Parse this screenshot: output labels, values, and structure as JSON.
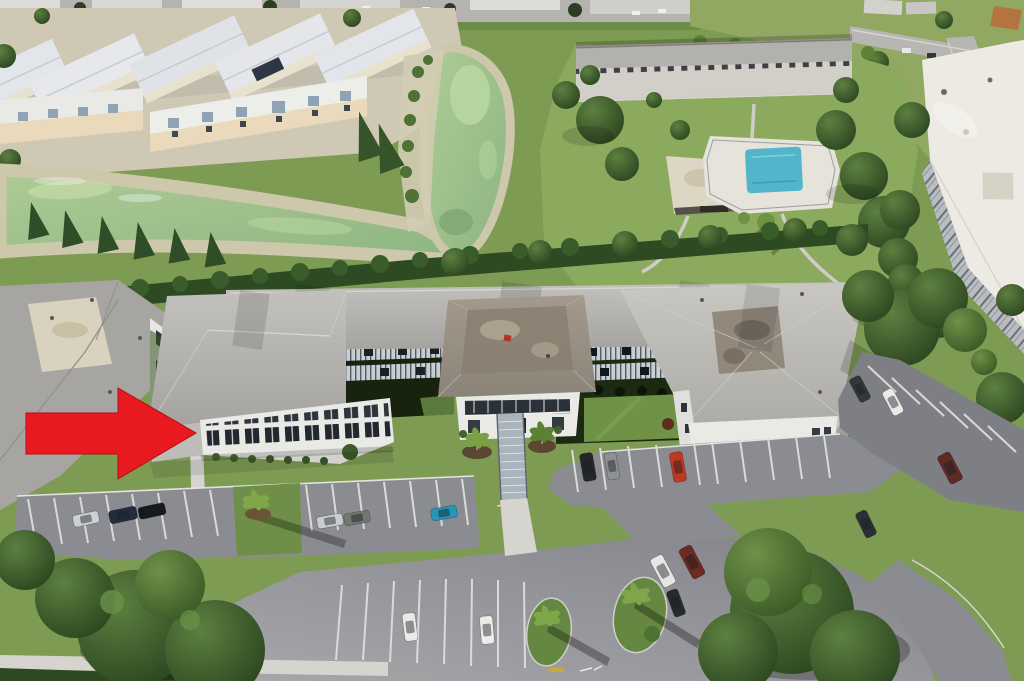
{
  "scene": {
    "type": "aerial-drone-photo",
    "subject": "three-story condominium building with hip roofs, central entrance tower and two courtyards",
    "surroundings": [
      "townhouse-complex",
      "green-pond-and-canal",
      "tree-hedge-row",
      "neighbor-condo-buildings",
      "community-pool-with-clubhouse",
      "high-rise-condo",
      "parking-lots-with-cars",
      "mature-trees-and-palms"
    ]
  },
  "annotation": {
    "arrow_color": "#e8191f",
    "arrow_outline": "#b40e14",
    "direction": "right",
    "points_to": "ground-floor corner unit of the left wing"
  },
  "palette": {
    "water": "#9cc18b",
    "water_light": "#bcd8a2",
    "pool": "#52b5c9",
    "grass": "#7d9b53",
    "lawn_bright": "#8caa5d",
    "asphalt": "#8b8c92",
    "asphalt_light": "#a0a1a6",
    "hedge": "#2e4a23",
    "sand": "#cdc7ac",
    "concrete": "#d6d4ce",
    "roof_light": "#b6b4b0",
    "roof_tower": "#968e81",
    "wall_white": "#e9e9e5",
    "stain_brown": "#8d8376"
  },
  "pool_area": {
    "pool_shape": "rectangular",
    "deck": "white",
    "clubhouse_roof": "white-tan",
    "fenced": true
  },
  "cars": [
    {
      "x": 86,
      "y": 519,
      "rot": -12,
      "len": 26,
      "wid": 12,
      "color": "#cdd0d3",
      "color_name": "silver"
    },
    {
      "x": 123,
      "y": 515,
      "rot": -12,
      "len": 28,
      "wid": 13,
      "color": "#232c3d",
      "color_name": "navy-pickup"
    },
    {
      "x": 152,
      "y": 511,
      "rot": -12,
      "len": 27,
      "wid": 12,
      "color": "#17181c",
      "color_name": "black"
    },
    {
      "x": 330,
      "y": 521,
      "rot": -10,
      "len": 26,
      "wid": 12,
      "color": "#c9ccce",
      "color_name": "silver"
    },
    {
      "x": 357,
      "y": 518,
      "rot": -10,
      "len": 26,
      "wid": 12,
      "color": "#73776f",
      "color_name": "gray"
    },
    {
      "x": 444,
      "y": 513,
      "rot": -10,
      "len": 26,
      "wid": 12,
      "color": "#2596b9",
      "color_name": "teal"
    },
    {
      "x": 410,
      "y": 627,
      "rot": 83,
      "len": 28,
      "wid": 13,
      "color": "#e9e9e7",
      "color_name": "white"
    },
    {
      "x": 487,
      "y": 630,
      "rot": 85,
      "len": 28,
      "wid": 13,
      "color": "#ececea",
      "color_name": "white"
    },
    {
      "x": 588,
      "y": 467,
      "rot": 80,
      "len": 28,
      "wid": 13,
      "color": "#24262a",
      "color_name": "black-suv"
    },
    {
      "x": 612,
      "y": 466,
      "rot": 80,
      "len": 27,
      "wid": 12,
      "color": "#8e9094",
      "color_name": "gray"
    },
    {
      "x": 678,
      "y": 467,
      "rot": 80,
      "len": 30,
      "wid": 13,
      "color": "#c03722",
      "color_name": "red"
    },
    {
      "x": 663,
      "y": 571,
      "rot": 62,
      "len": 32,
      "wid": 14,
      "color": "#e6e6e3",
      "color_name": "white-van"
    },
    {
      "x": 692,
      "y": 562,
      "rot": 62,
      "len": 33,
      "wid": 14,
      "color": "#6b2a22",
      "color_name": "maroon-truck"
    },
    {
      "x": 676,
      "y": 603,
      "rot": 70,
      "len": 27,
      "wid": 12,
      "color": "#26292e",
      "color_name": "dark"
    },
    {
      "x": 860,
      "y": 389,
      "rot": 62,
      "len": 26,
      "wid": 12,
      "color": "#33363b",
      "color_name": "dark"
    },
    {
      "x": 893,
      "y": 402,
      "rot": 62,
      "len": 27,
      "wid": 12,
      "color": "#e9e9e7",
      "color_name": "white"
    },
    {
      "x": 950,
      "y": 468,
      "rot": 62,
      "len": 31,
      "wid": 14,
      "color": "#5e2a24",
      "color_name": "maroon-suv"
    },
    {
      "x": 866,
      "y": 524,
      "rot": 64,
      "len": 27,
      "wid": 12,
      "color": "#2c2f34",
      "color_name": "dark"
    }
  ]
}
